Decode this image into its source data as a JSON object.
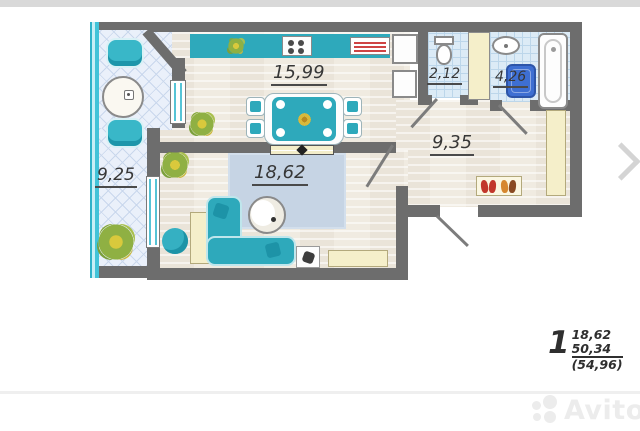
{
  "plan": {
    "rooms": {
      "kitchen": {
        "area": "15,99"
      },
      "toilet": {
        "area": "2,12"
      },
      "bathroom": {
        "area": "4,26"
      },
      "hallway": {
        "area": "9,35"
      },
      "living_room": {
        "area": "18,62"
      },
      "balcony": {
        "area": "9,25"
      }
    },
    "summary": {
      "rooms_count": "1",
      "living_area": "18,62",
      "apartment_area": "50,34",
      "total_area": "(54,96)"
    }
  },
  "watermark": {
    "brand": "Avito"
  },
  "icons": {
    "plant": "flower-blob",
    "next_arrow": "chevron-right",
    "avito_logo": "four-circles"
  },
  "colors": {
    "wall": "#6d6d6d",
    "accent_teal": "#2ea9bb",
    "glazing_cyan": "#42c3d8",
    "washer_blue": "#3e6fd2",
    "furniture_cream": "#f5efca",
    "tile_blue": "#dcebf6",
    "rug_blue_gray": "#c6d4e4",
    "shoe_red": "#c2372b",
    "shoe_orange": "#d6872f",
    "label_text": "#373737"
  }
}
